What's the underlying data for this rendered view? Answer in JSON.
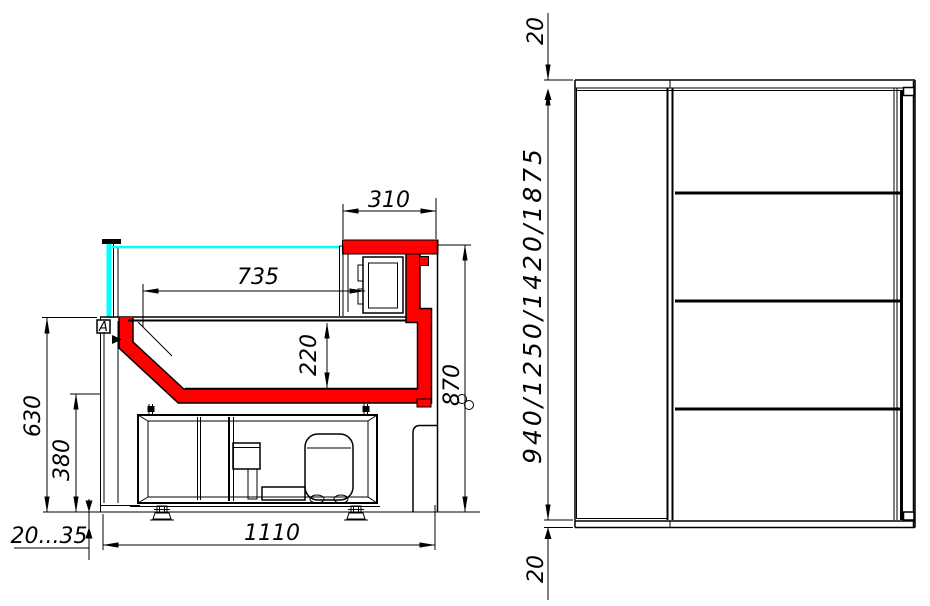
{
  "drawing": {
    "colors": {
      "accent_red": "#ff0000",
      "glass_cyan": "#00ffff",
      "line": "#000000",
      "background": "#ffffff"
    },
    "section_view": {
      "detail_marker": "A",
      "dims": {
        "canopy_depth": "310",
        "display_opening": "735",
        "well_depth": "220",
        "front_height": "630",
        "base_height": "380",
        "overall_height": "870",
        "overall_depth": "1110",
        "foot_adjust": "20...35"
      }
    },
    "front_view": {
      "dims": {
        "top_clearance": "20",
        "height_options": "940/1250/1420/1875",
        "bottom_clearance": "20"
      }
    }
  }
}
